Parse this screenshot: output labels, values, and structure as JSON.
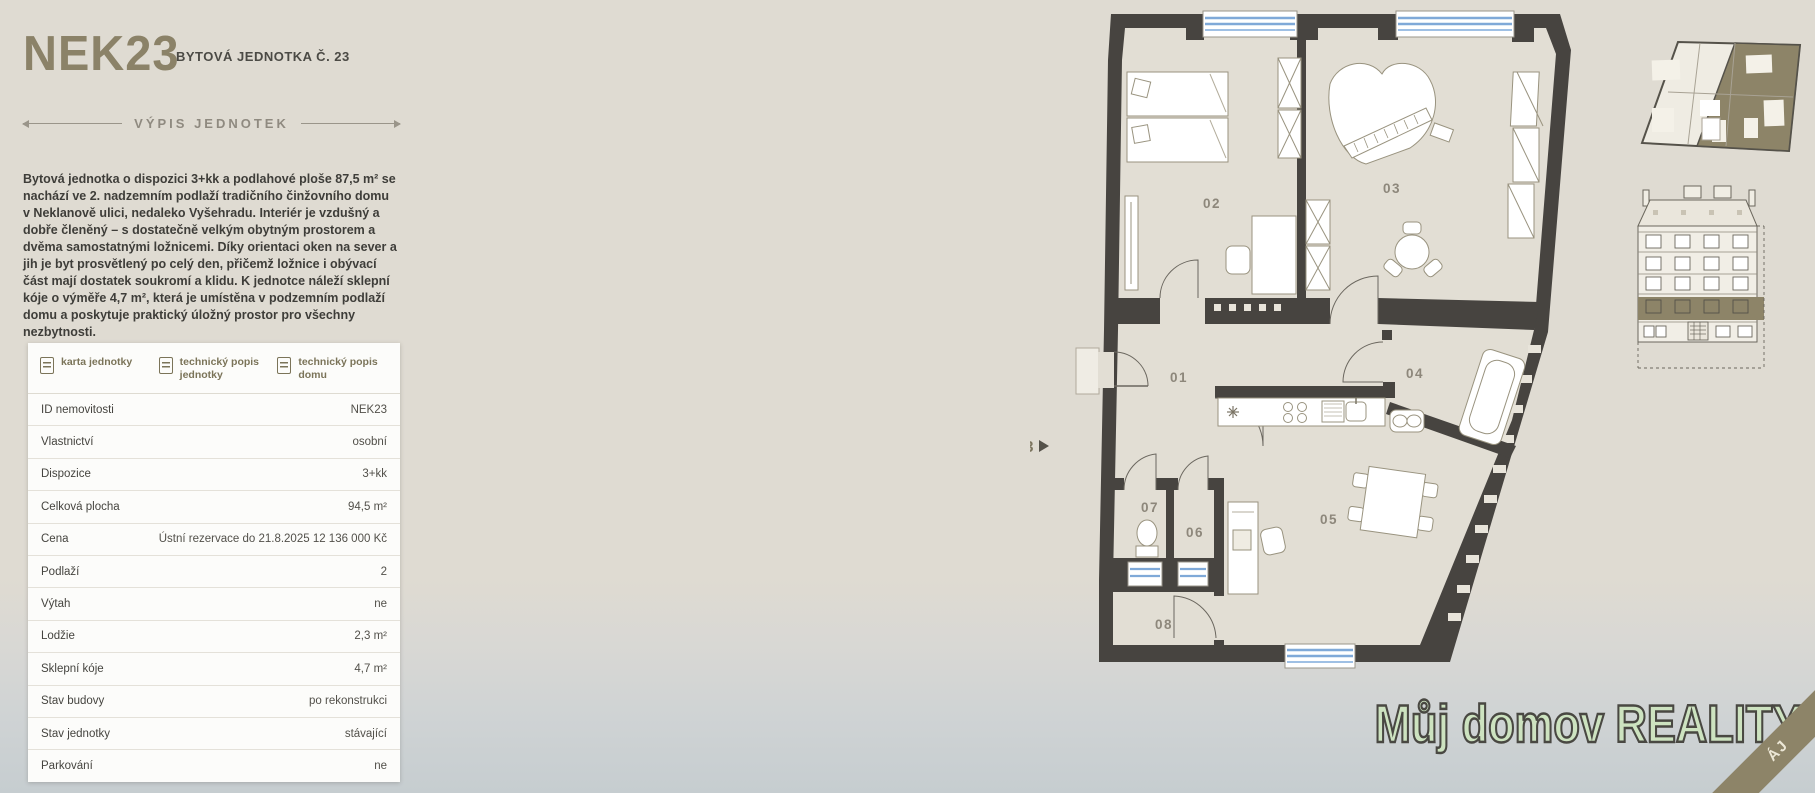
{
  "header": {
    "title": "NEK23",
    "subtitle": "BYTOVÁ JEDNOTKA Č. 23"
  },
  "section": {
    "heading": "VÝPIS JEDNOTEK"
  },
  "description": "Bytová jednotka o dispozici 3+kk a podlahové ploše 87,5 m² se nachází ve 2. nadzemním podlaží tradičního činžovního domu v Neklanově ulici, nedaleko Vyšehradu. Interiér je vzdušný a dobře členěný – s dostatečně velkým obytným prostorem a dvěma samostatnými ložnicemi. Díky orientaci oken na sever a jih je byt prosvětlený po celý den, přičemž ložnice i obývací část mají dostatek soukromí a klidu. K jednotce náleží sklepní kóje o výměře 4,7 m², která je umístěna v podzemním podlaží domu a poskytuje praktický úložný prostor pro všechny nezbytnosti.",
  "documents": [
    {
      "label": "karta jednotky"
    },
    {
      "label": "technický popis jednotky"
    },
    {
      "label": "technický popis domu"
    }
  ],
  "details": {
    "rows": [
      {
        "label": "ID nemovitosti",
        "value": "NEK23"
      },
      {
        "label": "Vlastnictví",
        "value": "osobní"
      },
      {
        "label": "Dispozice",
        "value": "3+kk"
      },
      {
        "label": "Celková plocha",
        "value": "94,5 m²"
      },
      {
        "label": "Cena",
        "value": "Ústní rezervace do 21.8.2025 12 136 000 Kč"
      },
      {
        "label": "Podlaží",
        "value": "2"
      },
      {
        "label": "Výtah",
        "value": "ne"
      },
      {
        "label": "Lodžie",
        "value": "2,3 m²"
      },
      {
        "label": "Sklepní kóje",
        "value": "4,7 m²"
      },
      {
        "label": "Stav budovy",
        "value": "po rekonstrukci"
      },
      {
        "label": "Stav jednotky",
        "value": "stávající"
      },
      {
        "label": "Parkování",
        "value": "ne"
      }
    ]
  },
  "floorplan": {
    "unit_label": "NEK23",
    "rooms": {
      "r01": "01",
      "r02": "02",
      "r03": "03",
      "r04": "04",
      "r05": "05",
      "r06": "06",
      "r07": "07",
      "r08": "08"
    }
  },
  "logo": {
    "part1": "Můj domov",
    "part2": "REALITY"
  },
  "ribbon": {
    "text": "ÁJ"
  },
  "colors": {
    "accent_olive": "#8b8268",
    "wall_dark": "#474440",
    "window_blue": "#7fa9d8",
    "logo_green": "#cde3c0",
    "page_bg": "#dfdbd2"
  }
}
